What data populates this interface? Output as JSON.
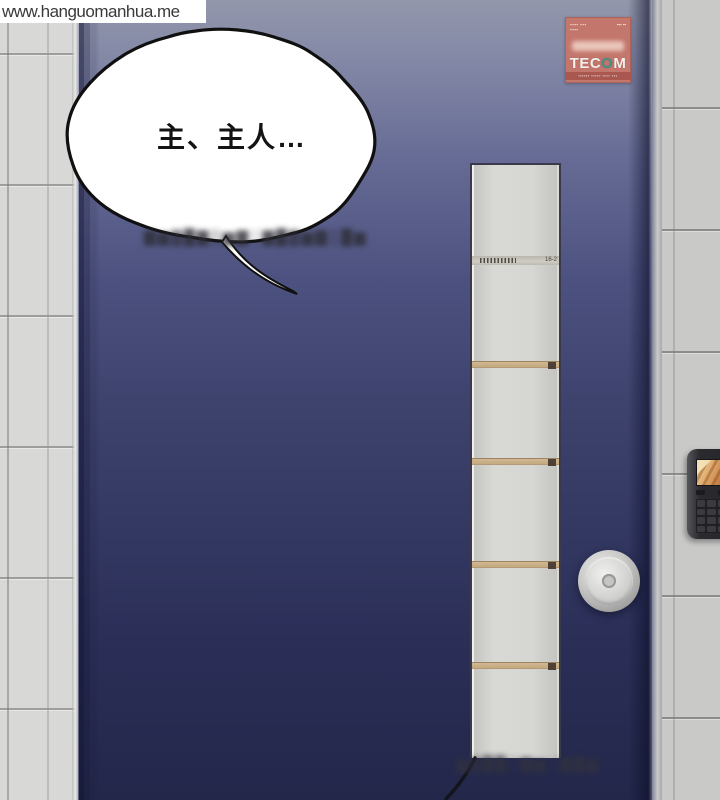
{
  "watermark": {
    "text": "www.hanguomanhua.me"
  },
  "speech_bubble": {
    "text": "主、主人…"
  },
  "door": {
    "window_tag_label": "16-2"
  },
  "sticker": {
    "brand_prefix": "TEC",
    "brand_o": "O",
    "brand_suffix": "M",
    "top_left_line1": "▪▪▪▪ ▪▪▪",
    "top_left_line2": "▪▪▪▪",
    "top_right_text": "▪▪▪ ▪▪",
    "bottom_text": "▪▪▪▪▪▪ ▪▪▪▪▪ ▪▪▪▪ ▪▪▪"
  },
  "blurred_text": {
    "below_bubble": "▇▆▓█▇▒▆▇░▇█▓▆▇▒█▆",
    "bottom": "▆▓██▒▇▆░▇█▆"
  },
  "colors": {
    "door_top": "#9397ab",
    "door_bottom": "#23274a",
    "wall_tile_left": "#d8d8d6",
    "wall_tile_right": "#c9c9c7",
    "window_panel": "#d6d6d3",
    "divider_tan": "#c9ae8a",
    "sticker_bg": "#c3766c",
    "sticker_brand_teal": "#3e9488",
    "lock_body": "#2b2b2f",
    "lock_screen_warm": "#dfa96b",
    "knob_metal": "#c6c6c4"
  }
}
